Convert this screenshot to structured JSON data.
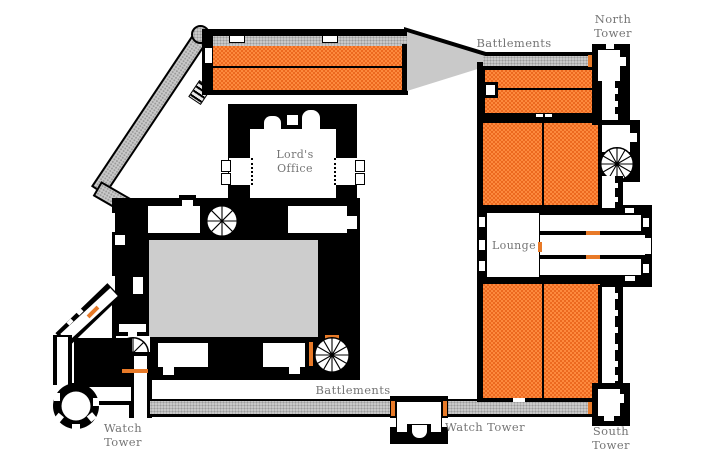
{
  "title": "Castle floor plan",
  "labels": {
    "battlements_north": "Battlements",
    "battlements_south": "Battlements",
    "north_tower_line1": "North",
    "north_tower_line2": "Tower",
    "south_tower_line1": "South",
    "south_tower_line2": "Tower",
    "watch_tower_sw_line1": "Watch",
    "watch_tower_sw_line2": "Tower",
    "watch_tower_south": "Watch Tower",
    "lords_office_line1": "Lord's",
    "lords_office_line2": "Office",
    "lounge": "Lounge"
  },
  "rooms": [
    "Lord's Office",
    "Lounge",
    "North Tower",
    "South Tower",
    "Watch Tower (southwest)",
    "Watch Tower (south)",
    "Battlements (north)",
    "Battlements (south)"
  ],
  "colors": {
    "wall": "#000000",
    "room_light": "#fd8a3e",
    "room_dark": "#ec691f",
    "walkway": "#c9c9c9",
    "courtyard": "#cdcdcd",
    "door": "#e87a28",
    "label": "#757575"
  }
}
